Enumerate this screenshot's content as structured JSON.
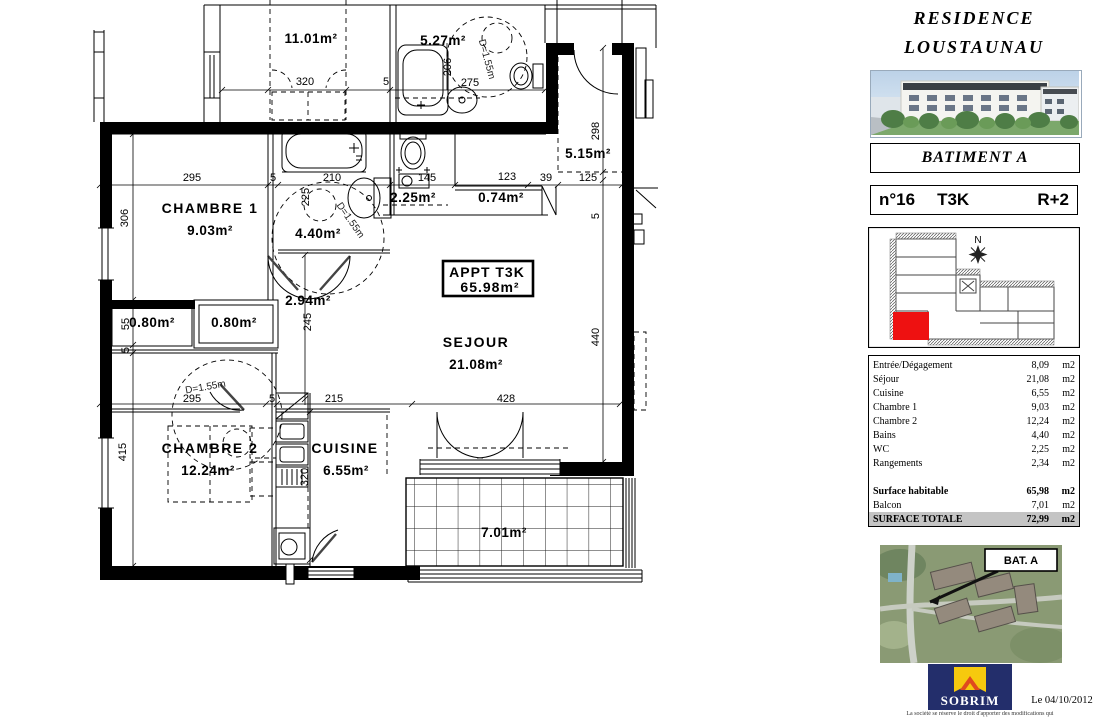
{
  "header": {
    "title_line1": "RESIDENCE",
    "title_line2": "LOUSTAUNAU"
  },
  "batiment": {
    "label": "BATIMENT A"
  },
  "unit": {
    "number": "n°16",
    "type": "T3K",
    "floor": "R+2"
  },
  "keyplan": {
    "north_label": "N"
  },
  "surface_table": {
    "rows": [
      {
        "label": "Entrée/Dégagement",
        "value": "8,09",
        "unit": "m2"
      },
      {
        "label": "Séjour",
        "value": "21,08",
        "unit": "m2"
      },
      {
        "label": "Cuisine",
        "value": "6,55",
        "unit": "m2"
      },
      {
        "label": "Chambre 1",
        "value": "9,03",
        "unit": "m2"
      },
      {
        "label": "Chambre 2",
        "value": "12,24",
        "unit": "m2"
      },
      {
        "label": "Bains",
        "value": "4,40",
        "unit": "m2"
      },
      {
        "label": "WC",
        "value": "2,25",
        "unit": "m2"
      },
      {
        "label": "Rangements",
        "value": "2,34",
        "unit": "m2"
      }
    ],
    "summary": [
      {
        "label": "Surface habitable",
        "value": "65,98",
        "unit": "m2"
      },
      {
        "label": "Balcon",
        "value": "7,01",
        "unit": "m2"
      },
      {
        "label": "SURFACE TOTALE",
        "value": "72,99",
        "unit": "m2"
      }
    ]
  },
  "aerial": {
    "bat_label": "BAT. A"
  },
  "footer": {
    "logo_text": "SOBRIM",
    "date": "Le 04/10/2012",
    "disclaimer": "La société se réserve le droit d'apporter des modifications qui"
  },
  "plan": {
    "apt_label_line1": "APPT  T3K",
    "apt_label_line2": "65.98m²",
    "rooms": {
      "chambre1_name": "CHAMBRE  1",
      "chambre1_area": "9.03m²",
      "chambre2_name": "CHAMBRE  2",
      "chambre2_area": "12.24m²",
      "sejour_name": "SEJOUR",
      "sejour_area": "21.08m²",
      "cuisine_name": "CUISINE",
      "cuisine_area": "6.55m²",
      "bains_area": "4.40m²",
      "wc_area": "2.25m²",
      "degagement_area": "2.94m²",
      "placard1_area": "0.80m²",
      "placard2_area": "0.80m²",
      "rangement_area": "0.74m²",
      "entree_area": "5.15m²",
      "balcon_area": "7.01m²",
      "neighbor_room_area": "11.01m²",
      "neighbor_bath_area": "5.27m²"
    },
    "annotations": {
      "d1": "D=1.55m",
      "d2": "D=1.55m",
      "d3": "D=1.55m"
    },
    "dims": {
      "top_320": "320",
      "top_5": "5",
      "top_206": "206",
      "top_275": "275",
      "mid_295": "295",
      "mid_5": "5",
      "mid_210": "210",
      "mid_225": "225",
      "mid_145": "145",
      "mid_123": "123",
      "mid_39": "39",
      "mid_125": "125",
      "left_306": "306",
      "left_55": "55",
      "left_5a": "5",
      "left_415": "415",
      "right_298": "298",
      "right_5": "5",
      "right_440": "440",
      "inner_245": "245",
      "inner_320": "320",
      "bot_295": "295",
      "bot_5": "5",
      "bot_215": "215",
      "bot_428": "428"
    }
  }
}
